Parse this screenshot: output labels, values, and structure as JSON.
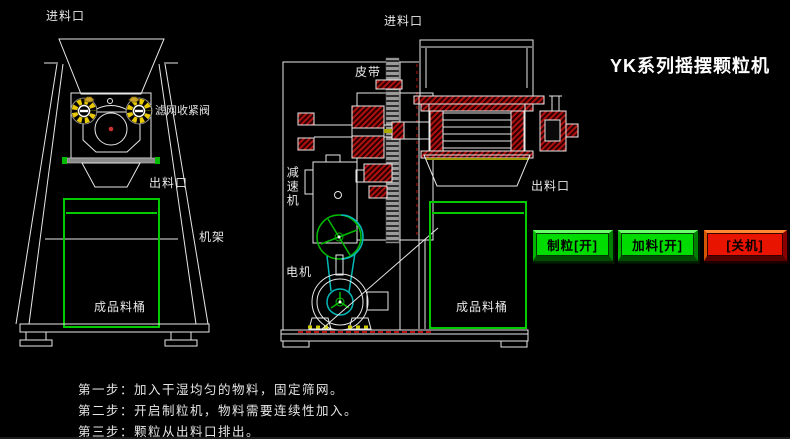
{
  "window": {
    "title": "YK系列摇摆颗粒机"
  },
  "front_view": {
    "inlet_label": "进料口",
    "valve_label": "滤网收紧阀",
    "outlet_label": "出料口",
    "frame_label": "机架",
    "barrel_label": "成品料桶"
  },
  "side_view": {
    "inlet_label": "进料口",
    "belt_label": "皮带",
    "reducer_label": "减速机",
    "motor_label": "电机",
    "outlet_label": "出料口",
    "barrel_label": "成品料桶"
  },
  "controls": {
    "buttons": [
      {
        "id": "granulate-on",
        "label": "制粒[开]",
        "color": "#00dc00"
      },
      {
        "id": "feed-on",
        "label": "加料[开]",
        "color": "#00dc00"
      },
      {
        "id": "shutdown",
        "label": "[关机]",
        "color": "#e81400"
      }
    ]
  },
  "instructions": {
    "steps": [
      "第一步：加入干湿均匀的物料，固定筛网。",
      "第二步：开启制粒机，物料需要连续性加入。",
      "第三步：颗粒从出料口排出。"
    ]
  },
  "colors": {
    "background": "#000000",
    "line_white": "#f0f0f0",
    "accent_green": "#00cc00",
    "accent_cyan": "#00b8b8",
    "hatch_red": "#b01010",
    "knob_yellow": "#e8c800",
    "screen_olive": "#9a9a00",
    "button_green": "#00dc00",
    "button_red": "#e81400"
  }
}
